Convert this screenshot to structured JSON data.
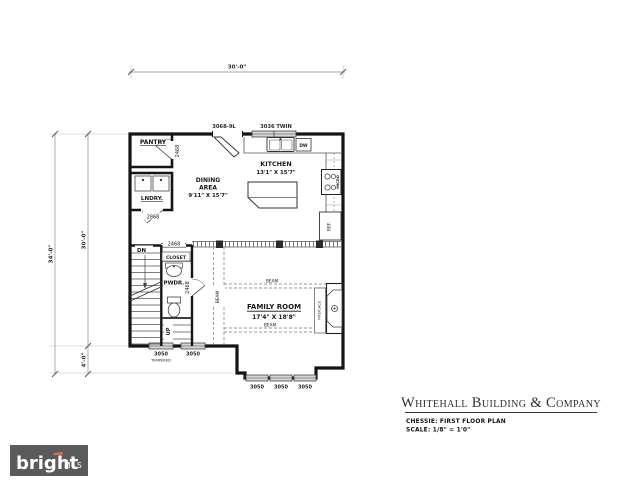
{
  "dimensions": {
    "top_width": "30'-0\"",
    "left_total": "34'-0\"",
    "left_upper": "30'-0\"",
    "left_lower": "4'-0\""
  },
  "rooms": {
    "pantry": "PANTRY",
    "laundry": "LNDRY.",
    "dining_line1": "DINING",
    "dining_line2": "AREA",
    "dining_size": "9'11\" X 15'7\"",
    "kitchen": "KITCHEN",
    "kitchen_size": "13'1\" X 15'7\"",
    "family": "FAMILY ROOM",
    "family_size": "17'4\" X 18'8\"",
    "closet": "CLOSET",
    "powder": "PWDR."
  },
  "doors": {
    "kitchen_rear": "3068-9L",
    "pantry": "2468",
    "laundry": "2868",
    "closet": "2468",
    "powder": "2468"
  },
  "windows": {
    "kitchen_twin": "3036 TWIN",
    "left_a": "3050",
    "left_b": "3050",
    "tempered": "TEMPERED",
    "bay_a": "3050",
    "bay_b": "3050",
    "bay_c": "3050"
  },
  "fixtures": {
    "dishwasher": "DW",
    "micro": "MICRO",
    "fridge": "REF.",
    "fireplace": "FIREPLACE"
  },
  "stairs": {
    "down": "DN",
    "up": "UP"
  },
  "beams": {
    "left": "BEAM",
    "upper": "BEAM",
    "lower": "BEAM"
  },
  "titleblock": {
    "company": "Whitehall Building & Company",
    "plan": "CHESSIE: FIRST FLOOR PLAN",
    "scale": "SCALE: 1/8\" = 1'0\""
  },
  "logo": {
    "brand": "bright",
    "suffix": "MLS"
  },
  "colors": {
    "wall": "#151515",
    "window_fill": "#d6d6d6",
    "logo_bg": "#595a5c",
    "logo_accent": "#dd7038"
  }
}
